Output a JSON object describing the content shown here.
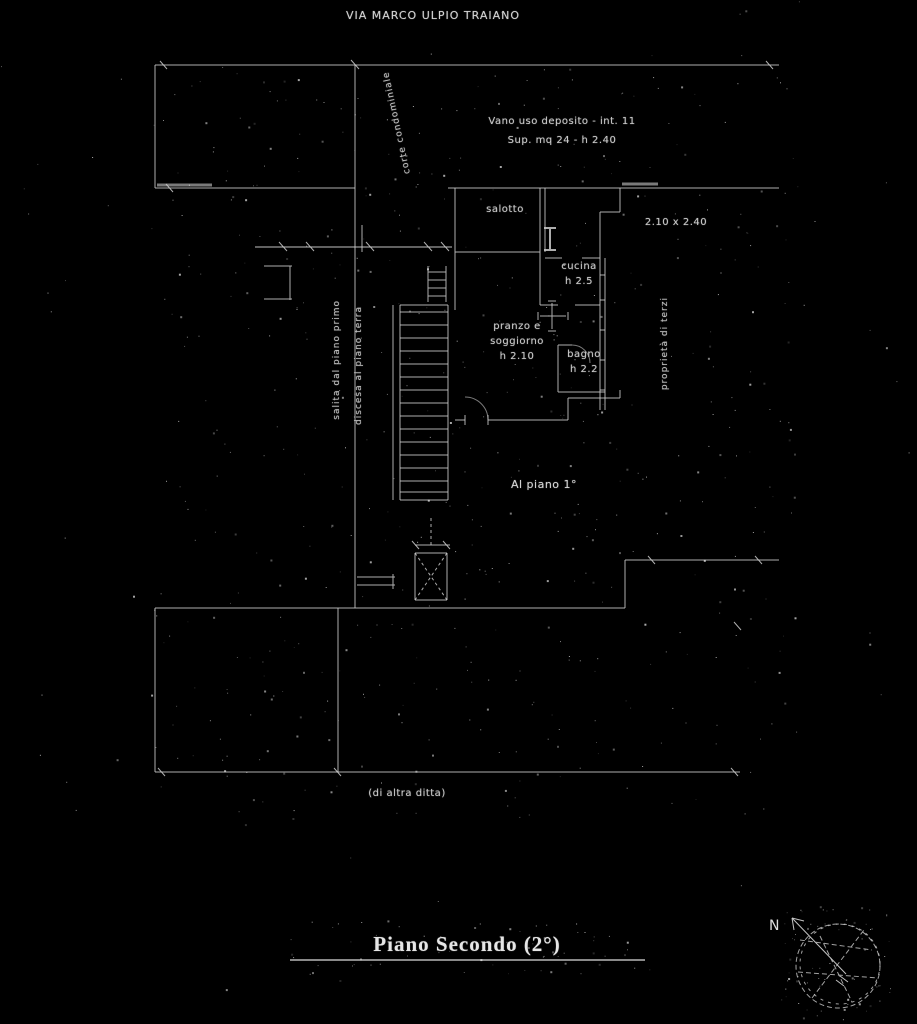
{
  "colors": {
    "background": "#000000",
    "line": "#cccccc",
    "thick_line": "#8f8f8f",
    "text": "#c9c9c9"
  },
  "header": {
    "street_label": "VIA MARCO ULPIO TRAIANO"
  },
  "plan": {
    "notes": {
      "line1": "Vano uso deposito - int. 11",
      "line2": "Sup. mq 24 - h 2.40"
    },
    "rooms": {
      "salotto": "salotto",
      "dimension": "2.10 x 2.40",
      "cucina": "cucina\nh 2.5",
      "soggiorno": "pranzo e\nsoggiorno\nh 2.10",
      "bagno": "bagno\nh 2.2",
      "al_piano": "Al piano 1°"
    },
    "annotations": {
      "stair_up": "salita dal piano primo",
      "stair_down": "discesa al piano terra",
      "court": "corte condominiale",
      "neighbor": "proprietà di terzi"
    },
    "parcel_note": "(di altra ditta)"
  },
  "footer": {
    "title": "Piano Secondo (2°)"
  },
  "compass": {
    "north_label": "N"
  }
}
